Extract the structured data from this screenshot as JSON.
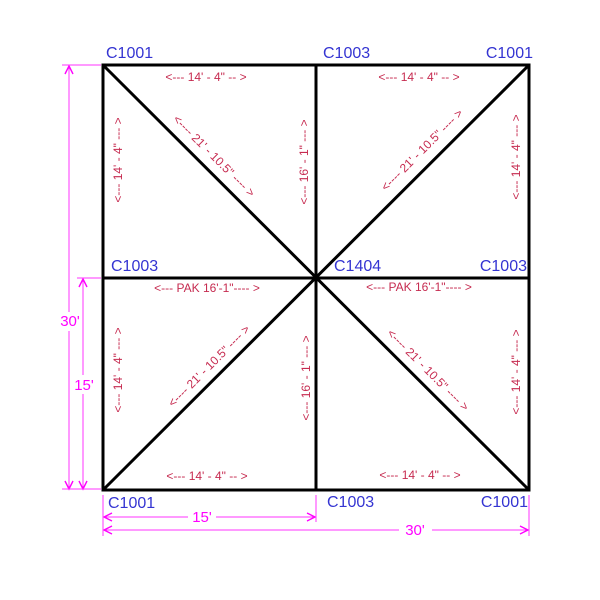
{
  "title": "tent-frame-plan-drawing",
  "colors": {
    "frame_line": "#000000",
    "part_label": "#3434d2",
    "member_dimension": "#c62b50",
    "overall_dimension": "#ff00ff",
    "background": "#ffffff"
  },
  "part_labels": {
    "top_left": "C1001",
    "top_center": "C1003",
    "top_right": "C1001",
    "mid_left": "C1003",
    "center": "C1404",
    "mid_right": "C1003",
    "bottom_left": "C1001",
    "bottom_center": "C1003",
    "bottom_right": "C1001"
  },
  "dims": {
    "panel_width": "<--- 14' - 4\" -- >",
    "panel_side": "<--- 14' - 4\" --- >",
    "diagonal": "<---- 21' - 10.5\" ---- >",
    "center_height": "<--- 16' - 1\" --- >",
    "pak": "<--- PAK 16'-1\"---- >",
    "overall_height": "30'",
    "half_height": "15'",
    "half_width": "15'",
    "overall_width": "30'"
  }
}
